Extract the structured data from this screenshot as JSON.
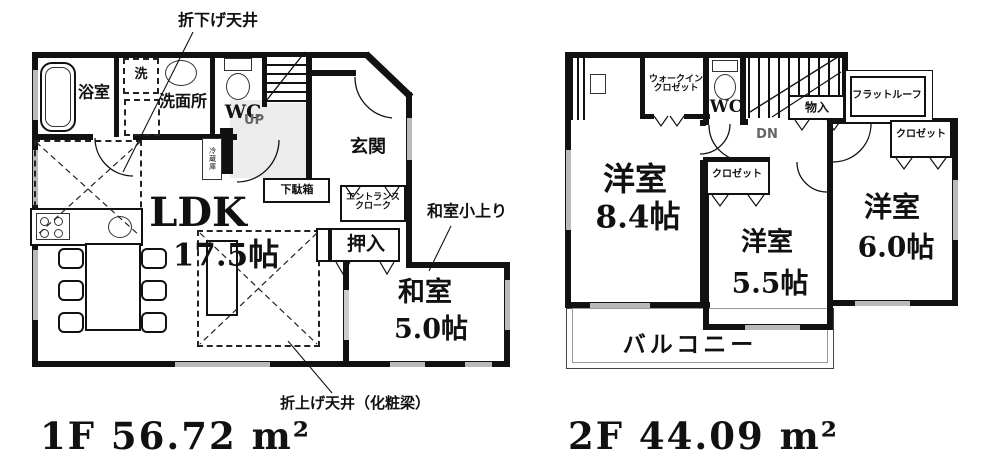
{
  "f1": {
    "area": "1F 56.72 m²",
    "oridage_ceiling": "折下げ天井",
    "bath": "浴室",
    "washer": "洗",
    "washroom": "洗面所",
    "wc": "WC",
    "up": "UP",
    "genkan": "玄関",
    "getabako": "下駄箱",
    "entrance_cloak_1": "エントランス",
    "entrance_cloak_2": "クローク",
    "fridge": "冷蔵庫",
    "ldk": "LDK",
    "ldk_size": "17.5帖",
    "oshiire": "押入",
    "washitsu": "和室",
    "washitsu_size": "5.0帖",
    "koagari_note": "和室小上り",
    "oriage_note": "折上げ天井（化粧梁）"
  },
  "f2": {
    "area": "2F 44.09 m²",
    "wic_1": "ウォークイン",
    "wic_2": "クロゼット",
    "wc": "WC",
    "dn": "DN",
    "monoire": "物入",
    "flat_roof": "フラットルーフ",
    "closet_a": "クロゼット",
    "closet_b": "クロゼット",
    "yoshitsu_a": "洋室",
    "yoshitsu_a_size": "8.4帖",
    "yoshitsu_b": "洋室",
    "yoshitsu_b_size": "5.5帖",
    "yoshitsu_c": "洋室",
    "yoshitsu_c_size": "6.0帖",
    "balcony": "バルコニー"
  }
}
